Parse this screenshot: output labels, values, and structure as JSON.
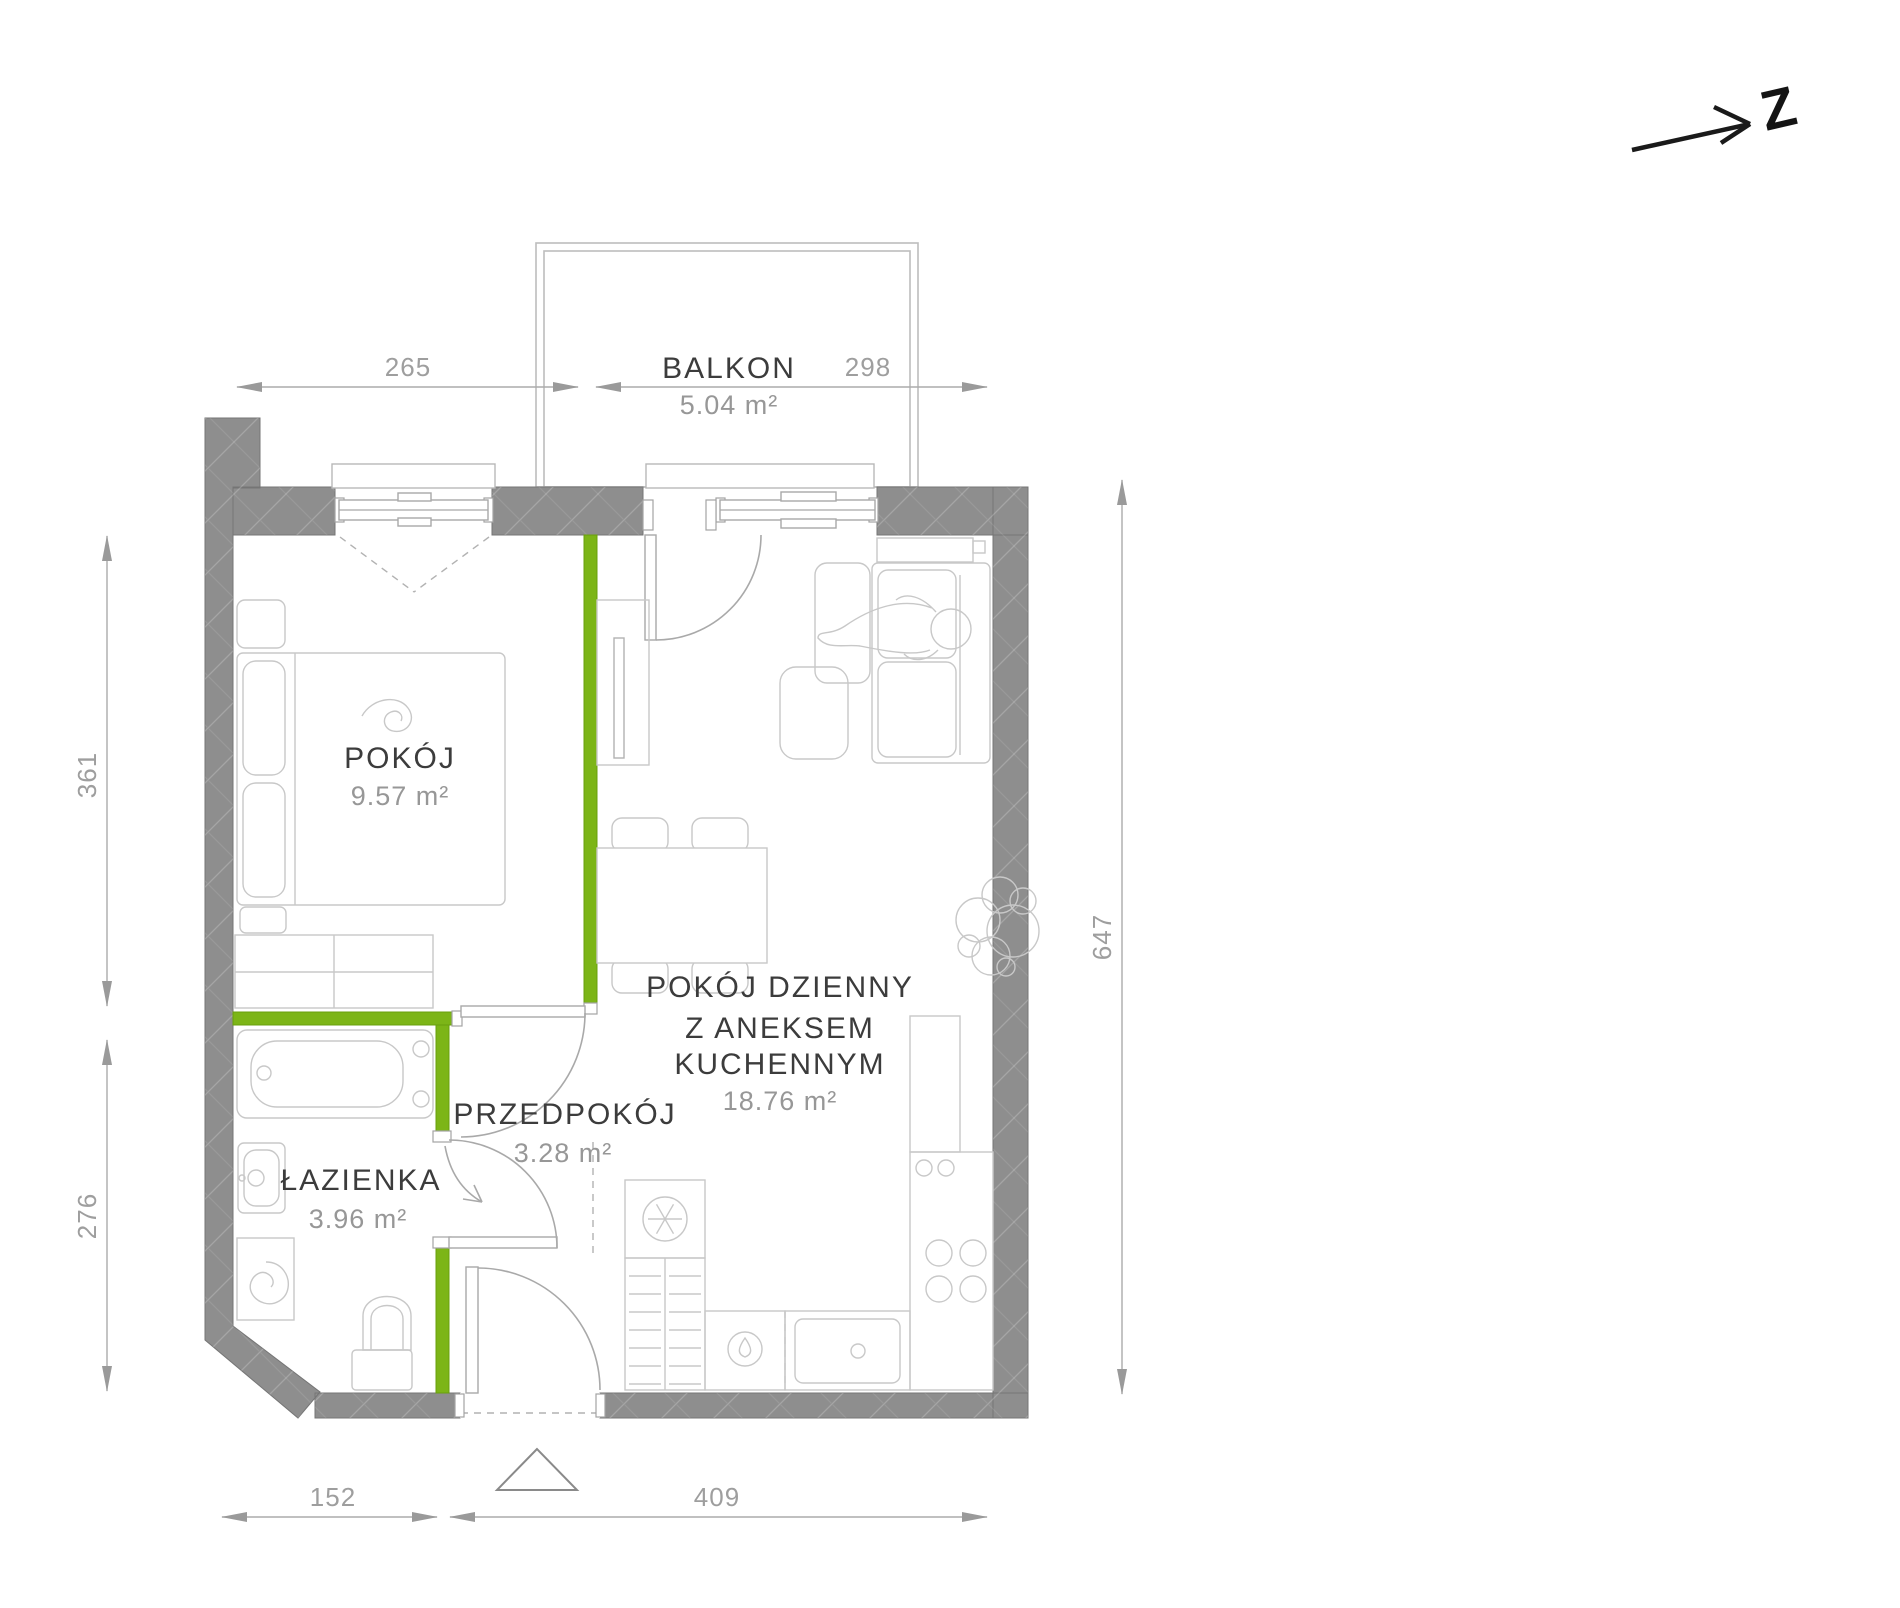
{
  "title": "apartment-floor-plan",
  "compass": {
    "label": "Z"
  },
  "rooms": {
    "balkon": {
      "name": "BALKON",
      "area": "5.04 m²"
    },
    "pokoj": {
      "name": "POKÓJ",
      "area": "9.57 m²"
    },
    "salon": {
      "line1": "POKÓJ DZIENNY",
      "line2": "Z ANEKSEM",
      "line3": "KUCHENNYM",
      "area": "18.76 m²"
    },
    "przedpokoj": {
      "name": "PRZEDPOKÓJ",
      "area": "3.28 m²"
    },
    "lazienka": {
      "name": "ŁAZIENKA",
      "area": "3.96 m²"
    }
  },
  "dimensions_cm": {
    "top_left": "265",
    "top_right": "298",
    "left_upper": "361",
    "left_lower": "276",
    "right": "647",
    "bottom_left": "152",
    "bottom_right": "409"
  },
  "colors": {
    "wall": "#8e8e8e",
    "wall_outline": "#767676",
    "green_wall": "#7cb517",
    "dim": "#9e9e9e",
    "label": "#3c3c3c",
    "area_text": "#979797",
    "furniture": "#c8c8c8",
    "compass_ink": "#1a1a1a"
  }
}
